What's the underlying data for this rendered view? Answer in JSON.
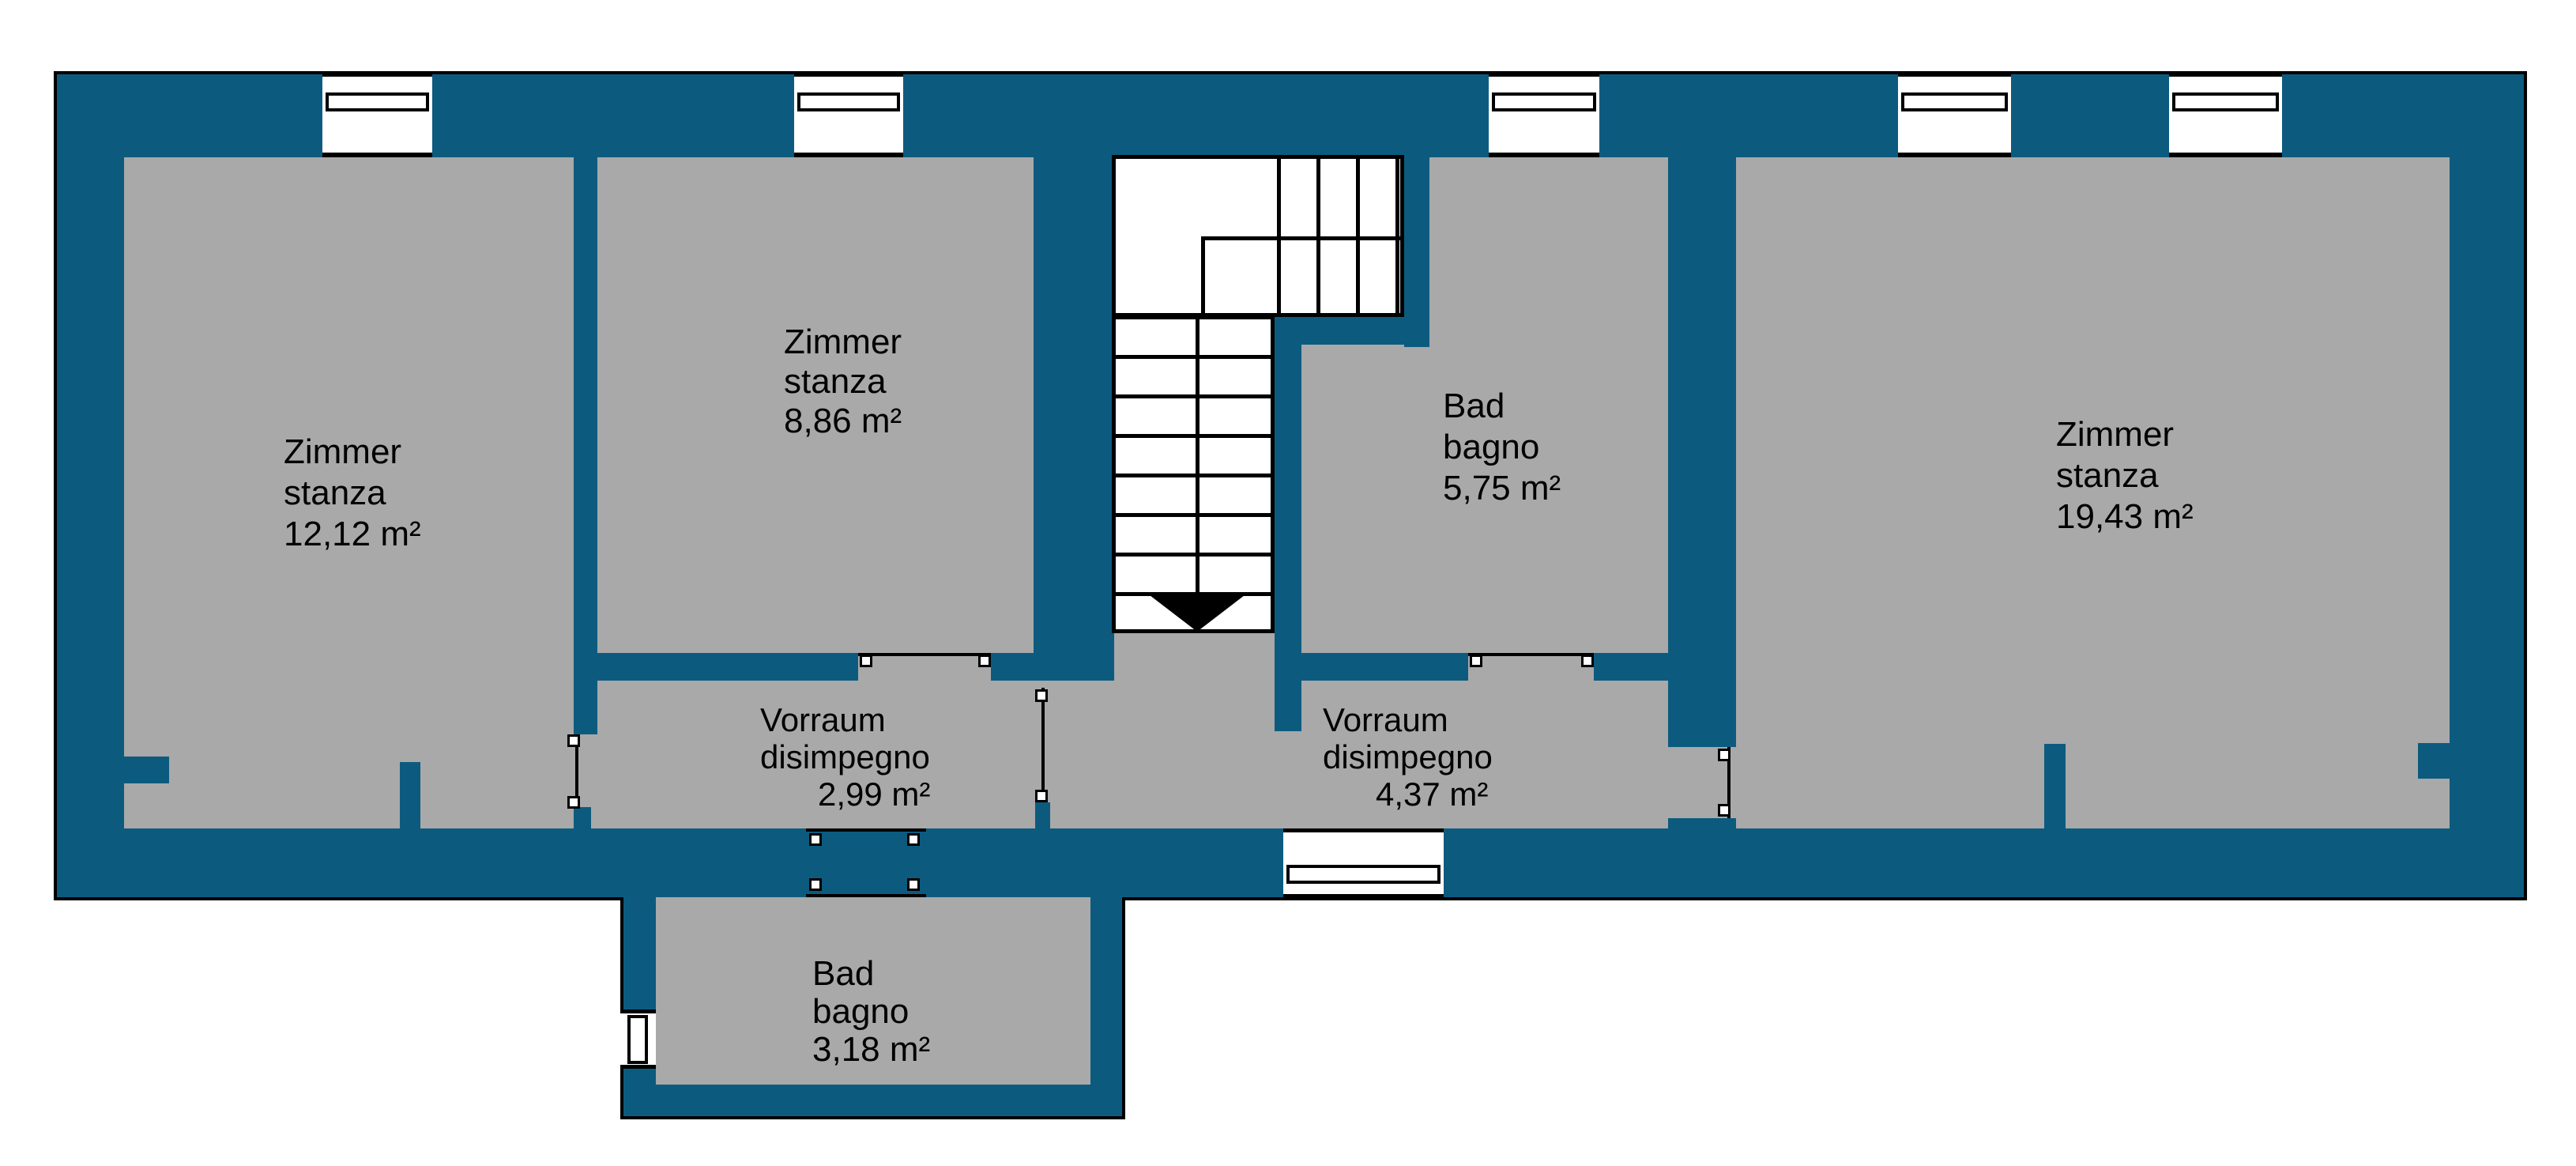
{
  "colors": {
    "wall": "#0c5b7f",
    "floor": "#a9a9a9",
    "line": "#000000",
    "background": "#ffffff"
  },
  "rooms": [
    {
      "key": "zimmer-12",
      "name_de": "Zimmer",
      "name_it": "stanza",
      "area": "12,12 m²"
    },
    {
      "key": "zimmer-8",
      "name_de": "Zimmer",
      "name_it": "stanza",
      "area": "8,86 m²"
    },
    {
      "key": "bad-5",
      "name_de": "Bad",
      "name_it": "bagno",
      "area": "5,75 m²"
    },
    {
      "key": "zimmer-19",
      "name_de": "Zimmer",
      "name_it": "stanza",
      "area": "19,43 m²"
    },
    {
      "key": "vorraum-2",
      "name_de": "Vorraum",
      "name_it": "disimpegno",
      "area": "2,99 m²"
    },
    {
      "key": "vorraum-4",
      "name_de": "Vorraum",
      "name_it": "disimpegno",
      "area": "4,37 m²"
    },
    {
      "key": "bad-3",
      "name_de": "Bad",
      "name_it": "bagno",
      "area": "3,18 m²"
    }
  ]
}
